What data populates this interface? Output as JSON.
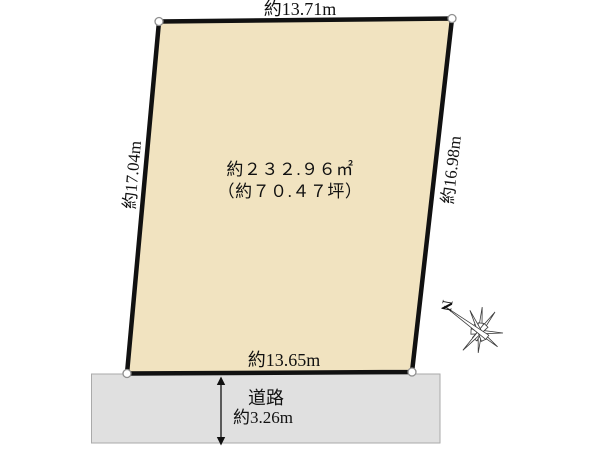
{
  "diagram": {
    "plot": {
      "top_dimension": "約13.71m",
      "left_dimension": "約17.04m",
      "right_dimension": "約16.98m",
      "bottom_dimension": "約13.65m",
      "area_m2": "約２３２.９６㎡",
      "area_tsubo": "（約７０.４７坪）"
    },
    "road": {
      "label": "道路",
      "width": "約3.26m"
    },
    "compass": {
      "north_label": "N"
    },
    "colors": {
      "plot_fill": "#f1e3c0",
      "plot_border": "#111111",
      "road_fill": "#e0e0e0",
      "road_border": "#aaaaaa"
    }
  }
}
